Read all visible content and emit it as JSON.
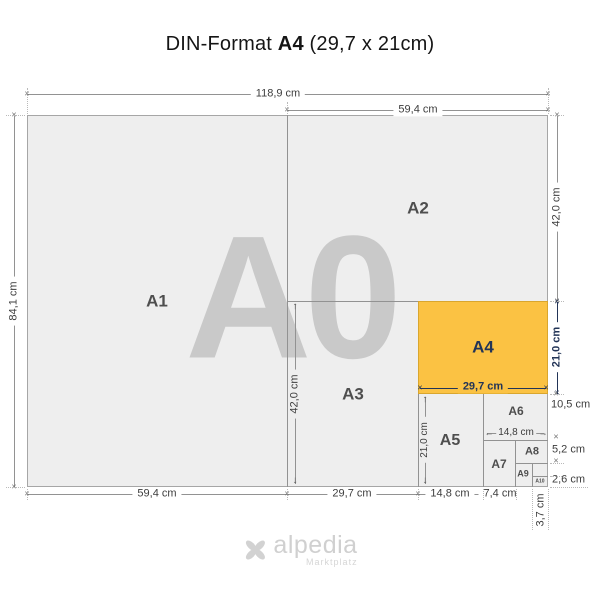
{
  "title": {
    "part1": "DIN-Format",
    "part2": "A4",
    "part3": "(29,7 x 21cm)"
  },
  "watermark": "A0",
  "formats": {
    "a1": "A1",
    "a2": "A2",
    "a3": "A3",
    "a4": "A4",
    "a5": "A5",
    "a6": "A6",
    "a7": "A7",
    "a8": "A8",
    "a9": "A9",
    "a10": "A10"
  },
  "dims": {
    "total_width": "118,9 cm",
    "half_width": "59,4 cm",
    "total_height": "84,1 cm",
    "a2_height": "42,0 cm",
    "a4_height": "21,0 cm",
    "a6_height": "10,5 cm",
    "a8_height": "5,2 cm",
    "a10_height": "2,6 cm",
    "a1_width": "59,4 cm",
    "a3_width": "29,7 cm",
    "a5_width": "14,8 cm",
    "a7_width": "7,4 cm",
    "a9_width": "3,7 cm",
    "a3_height": "42,0 cm",
    "a4_width": "29,7 cm",
    "a5_height": "21,0 cm",
    "a6_width": "14,8 cm"
  },
  "glyphs": {
    "end": "×",
    "up": "↑",
    "down": "↓",
    "left": "←",
    "right": "→"
  },
  "footer": {
    "brand": "alpedia",
    "tagline": "Marktplatz"
  },
  "colors": {
    "highlight": "#fbc243",
    "highlight_border": "#d9a62e",
    "highlight_text": "#223457",
    "paper": "#eeeeee",
    "line": "#929292",
    "watermark": "#c9c9c9",
    "dim_text": "#3d3d3d"
  }
}
